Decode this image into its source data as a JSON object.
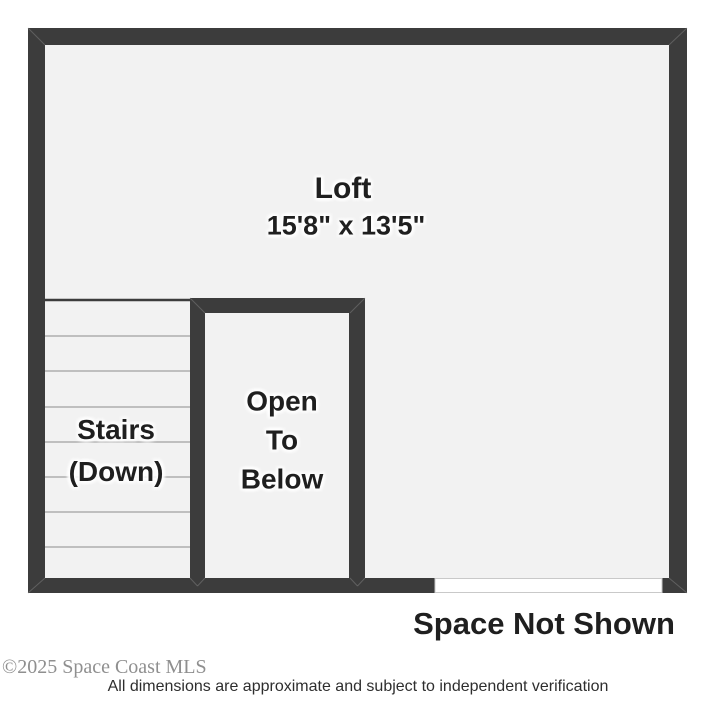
{
  "plan": {
    "loft": {
      "label": "Loft",
      "dimensions": "15'8\" x 13'5\""
    },
    "stairs": {
      "lines": [
        "Stairs",
        "(Down)"
      ]
    },
    "open_to_below": {
      "lines": [
        "Open",
        "To",
        "Below"
      ]
    },
    "space_not_shown_label": "Space Not Shown"
  },
  "footer": {
    "copyright": "©2025 Space Coast MLS",
    "disclaimer": "All dimensions are approximate and subject to independent verification"
  },
  "colors": {
    "wall": "#3c3c3c",
    "floor": "#f2f2f2",
    "tread": "#8c8c8c",
    "ink": "#1f1f1f",
    "muted": "#8f8f8f",
    "opening-border": "#c9c9c9"
  }
}
